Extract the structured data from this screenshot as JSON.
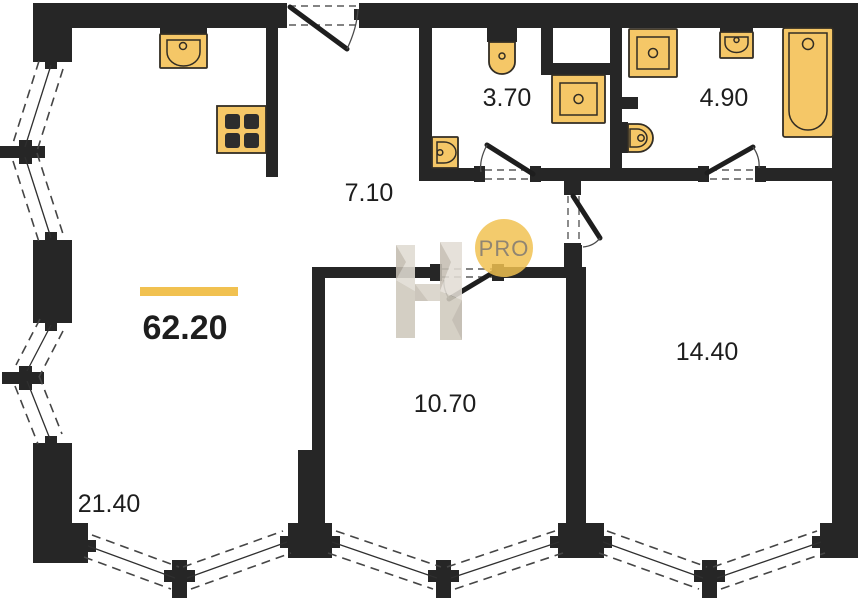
{
  "colors": {
    "wall": "#262626",
    "fixture": "#f5c767",
    "fixture_stroke": "#322d24",
    "accent": "#f1c150",
    "watermark_light": "#e0dbd2",
    "watermark_dark": "#c6bfb3",
    "text": "#1d1d1d",
    "background": "#ffffff"
  },
  "plan": {
    "total_area": "62.20",
    "rooms": [
      {
        "name": "living-room",
        "area": "21.40"
      },
      {
        "name": "hallway",
        "area": "7.10"
      },
      {
        "name": "bathroom-small",
        "area": "3.70"
      },
      {
        "name": "bathroom-large",
        "area": "4.90"
      },
      {
        "name": "bedroom-small",
        "area": "10.70"
      },
      {
        "name": "bedroom-large",
        "area": "14.40"
      }
    ],
    "fixtures": [
      "kitchen-sink-icon",
      "stove-icon",
      "toilet-icon",
      "washing-machine-icon",
      "wall-sink-icon",
      "washing-machine-2-icon",
      "hand-sink-icon",
      "bathtub-icon",
      "toilet-2-icon"
    ]
  },
  "watermark": {
    "letter": "Н",
    "badge_text": "PRO"
  }
}
